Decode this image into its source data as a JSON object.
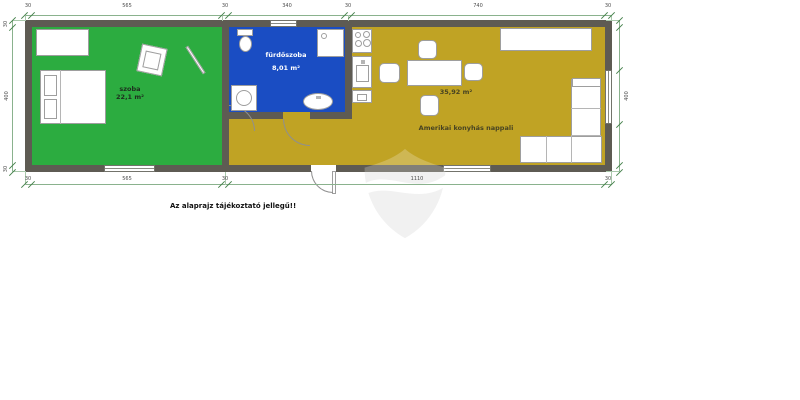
{
  "caption": "Az alaprajz tájékoztató jellegű!!",
  "rooms": [
    {
      "name": "szoba",
      "area": "22,1 m²",
      "color": "#2cac40"
    },
    {
      "name": "fürdőszoba",
      "area": "8,01 m²",
      "color": "#1a4dc3"
    },
    {
      "name": "Amerikai konyhás nappali",
      "area": "35,92 m²",
      "color": "#c0a324"
    }
  ],
  "dimensions": {
    "top": [
      "30",
      "565",
      "30",
      "340",
      "30",
      "740",
      "30"
    ],
    "bottom": [
      "30",
      "565",
      "30",
      "1110",
      "30"
    ],
    "left": [
      "30",
      "400",
      "30"
    ],
    "right": [
      "400"
    ]
  },
  "colors": {
    "wall": "#5e5b53",
    "bedroom_floor": "#2cac40",
    "bathroom_floor": "#1a4dc3",
    "living_floor": "#c0a324",
    "dimension_line": "#8ab28d",
    "watermark": "#ededed"
  },
  "furniture_icons": [
    "wardrobe",
    "double-bed",
    "armchair",
    "mirror",
    "toilet",
    "shower",
    "washing-machine",
    "bathroom-sink",
    "cooktop",
    "kitchen-sink",
    "kitchen-cabinet",
    "dining-table",
    "chair",
    "sideboard",
    "corner-sofa"
  ]
}
